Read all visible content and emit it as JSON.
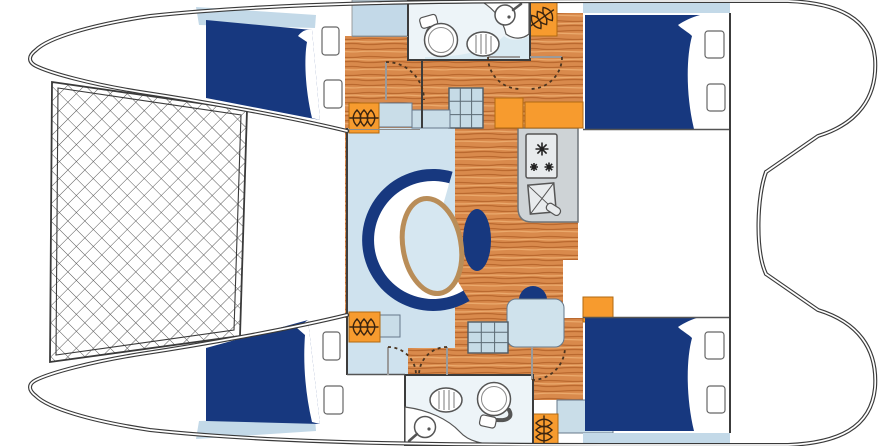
{
  "diagram": {
    "title": "Catamaran interior layout floor plan",
    "view": "top-down deck plan, bows at left, twin sugar-scoop sterns at right",
    "palette": {
      "navy": "#17387f",
      "wood_base": "#d98a4c",
      "wood_grain_dark": "#ba692f",
      "wood_grain_light": "#eaa96c",
      "orange": "#f79b2e",
      "orange_border": "#b06a12",
      "saloon_blue": "#cfe2ee",
      "pale_blue": "#c3d9e8",
      "blue_block": "#c9dde8",
      "steps_blue": "#c6dbe6",
      "table_top": "#d6e7f1",
      "table_rim": "#b98d58",
      "desk_blue": "#cfe2ec",
      "counter_gray": "#ced3d6",
      "appliance_gray": "#e8ebed",
      "room_tint": "#edf4f8",
      "bath_band": "#d9eaf2",
      "outline": "#3a3a3a",
      "net_line": "#565656",
      "coil_brown": "#3a2410",
      "door_arc": "#4a3420",
      "white": "#ffffff"
    },
    "areas": {
      "bow": {
        "trampoline": "cross-hatched net panel laced between the two bows"
      },
      "saloon": {
        "sofa": "C-shaped settee, navy backrest band, white cushions, opening faces aft",
        "table": "oval table, light blue top with wood rim",
        "seats": [
          "kidney-shaped stool",
          "half-round stool"
        ]
      },
      "galley": {
        "counter": "gray worktop",
        "stove_burners": 3,
        "sink": "square basin with X and lever faucet"
      },
      "chart_desk": "rounded light-blue desk beside port companionway",
      "companionways": [
        "starboard 3x3 step grid",
        "port 3x3 step grid"
      ],
      "bathrooms": [
        {
          "location": "starboard hull",
          "fixtures": [
            "toilet with cistern",
            "oval hatched basin",
            "corner washbasin with faucet"
          ]
        },
        {
          "location": "port hull",
          "fixtures": [
            "toilet with cistern",
            "oval hatched basin",
            "corner washbasin with faucet"
          ]
        }
      ],
      "cabins": [
        "starboard forward double berth",
        "starboard aft double berth",
        "port forward double berth",
        "port aft double berth"
      ],
      "berth_details": "navy mattress with white turned-down sheet fold and pale-blue pillow shelf",
      "storage": {
        "hanging_lockers": 4,
        "cabinets": "orange blocks along companionways"
      },
      "doors": "6 dashed quarter-circle swing arcs",
      "sterns": "twin sugar-scoop transoms with aft bulkhead"
    }
  }
}
